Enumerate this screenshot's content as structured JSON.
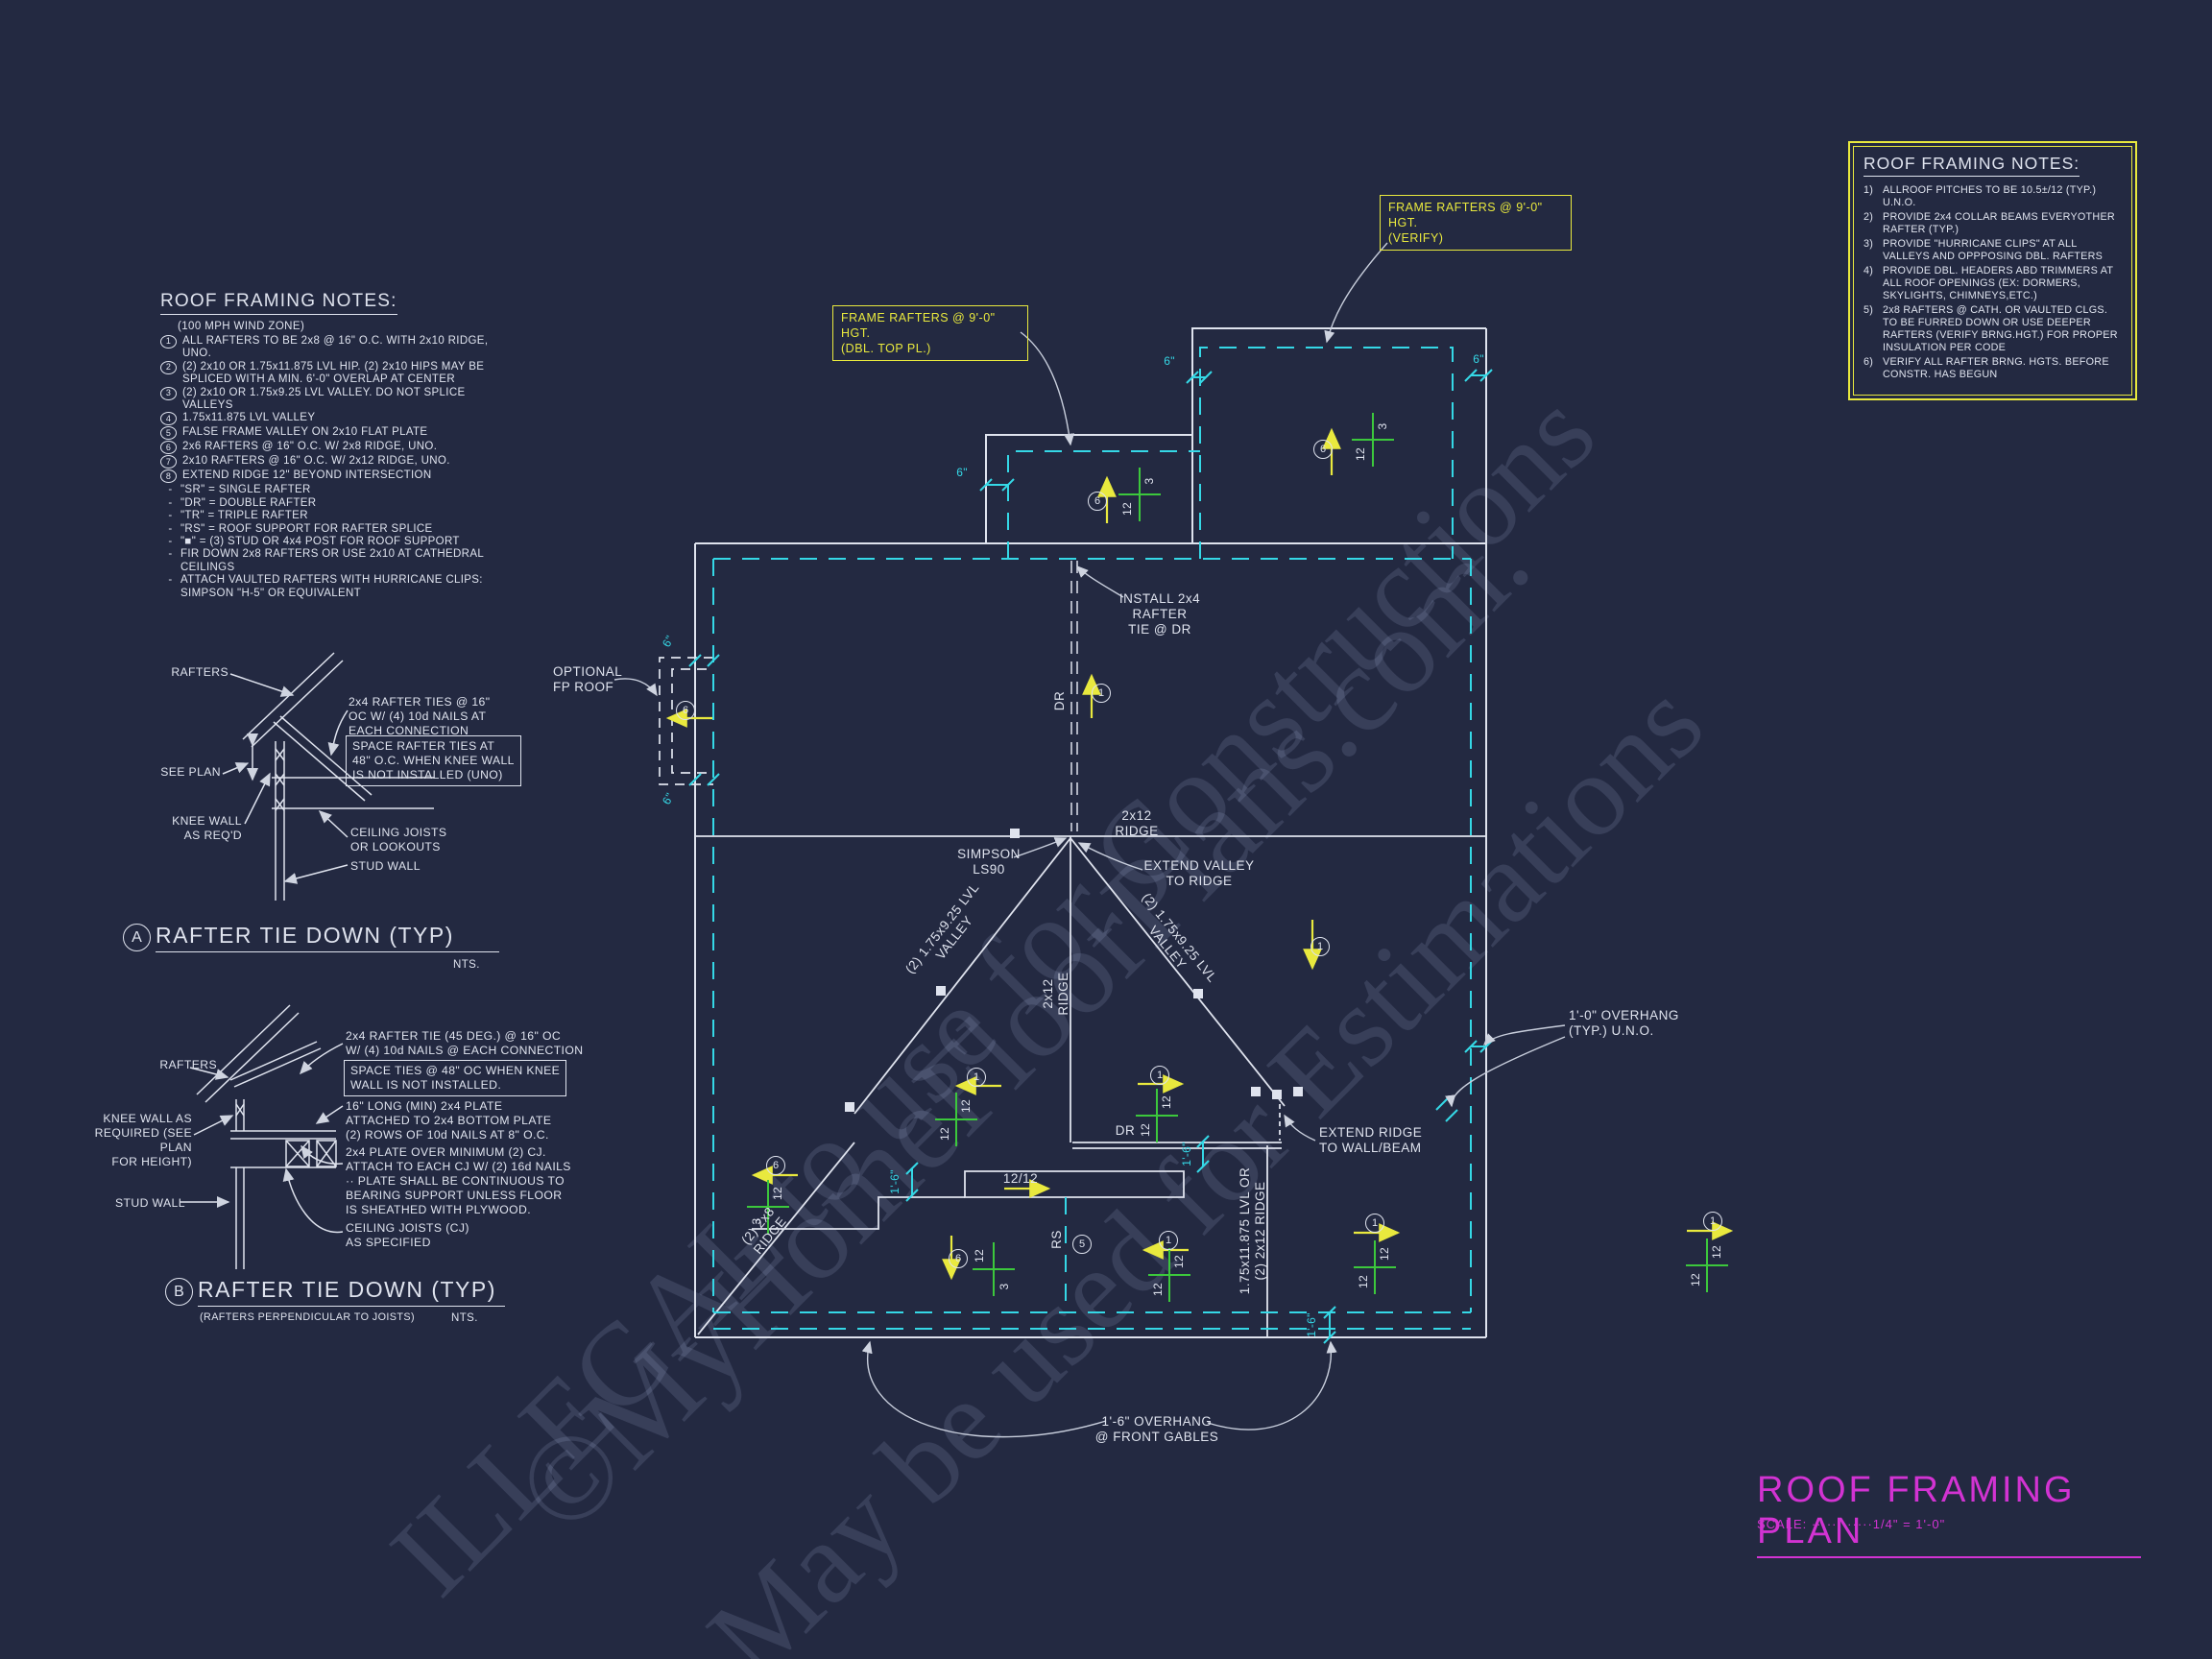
{
  "watermarks": {
    "w1": "©MyHomeFloorPlans.com.",
    "w2": "ILLEGAL to use for Constructions",
    "w3": "May be used for Estimations"
  },
  "left_notes": {
    "title": "ROOF FRAMING NOTES:",
    "subtitle": "(100 MPH WIND ZONE)",
    "numbered": [
      {
        "n": "1",
        "t": "ALL RAFTERS TO BE 2x8 @ 16\" O.C. WITH 2x10 RIDGE, UNO."
      },
      {
        "n": "2",
        "t": "(2) 2x10 OR 1.75x11.875 LVL HIP. (2) 2x10 HIPS MAY BE SPLICED WITH A MIN. 6'-0\" OVERLAP AT CENTER"
      },
      {
        "n": "3",
        "t": "(2) 2x10 OR 1.75x9.25 LVL VALLEY. DO NOT SPLICE VALLEYS"
      },
      {
        "n": "4",
        "t": "1.75x11.875 LVL VALLEY"
      },
      {
        "n": "5",
        "t": "FALSE FRAME VALLEY ON 2x10 FLAT PLATE"
      },
      {
        "n": "6",
        "t": "2x6 RAFTERS @ 16\" O.C. W/ 2x8 RIDGE, UNO."
      },
      {
        "n": "7",
        "t": "2x10 RAFTERS @ 16\" O.C. W/ 2x12 RIDGE, UNO."
      },
      {
        "n": "8",
        "t": "EXTEND RIDGE 12\" BEYOND INTERSECTION"
      }
    ],
    "dashed": [
      {
        "n": "-",
        "t": "\"SR\" = SINGLE RAFTER"
      },
      {
        "n": "-",
        "t": "\"DR\" = DOUBLE RAFTER"
      },
      {
        "n": "-",
        "t": "\"TR\" = TRIPLE RAFTER"
      },
      {
        "n": "-",
        "t": "\"RS\" = ROOF SUPPORT FOR RAFTER SPLICE"
      },
      {
        "n": "-",
        "t": "\"■\"  = (3) STUD OR 4x4 POST FOR ROOF SUPPORT"
      },
      {
        "n": "-",
        "t": "FIR DOWN 2x8 RAFTERS OR USE 2x10 AT CATHEDRAL CEILINGS"
      },
      {
        "n": "-",
        "t": "ATTACH VAULTED RAFTERS WITH HURRICANE CLIPS: SIMPSON \"H-5\" OR EQUIVALENT"
      }
    ]
  },
  "right_notes": {
    "title": "ROOF FRAMING NOTES:",
    "items": [
      {
        "n": "1)",
        "t": "ALLROOF PITCHES TO BE  10.5±/12 (TYP.) U.N.O."
      },
      {
        "n": "2)",
        "t": "PROVIDE 2x4 COLLAR BEAMS EVERYOTHER RAFTER (TYP.)"
      },
      {
        "n": "3)",
        "t": "PROVIDE \"HURRICANE CLIPS\" AT ALL VALLEYS AND OPPPOSING DBL. RAFTERS"
      },
      {
        "n": "4)",
        "t": "PROVIDE DBL. HEADERS ABD TRIMMERS AT ALL ROOF OPENINGS (EX: DORMERS, SKYLIGHTS, CHIMNEYS,ETC.)"
      },
      {
        "n": "5)",
        "t": "2x8 RAFTERS @ CATH. OR VAULTED CLGS. TO BE FURRED DOWN OR USE DEEPER RAFTERS (VERIFY BRNG.HGT.) FOR PROPER INSULATION PER CODE"
      },
      {
        "n": "6)",
        "t": "VERIFY ALL RAFTER BRNG. HGTS. BEFORE CONSTR. HAS BEGUN"
      }
    ]
  },
  "callouts": {
    "verify": {
      "l1": "FRAME RAFTERS @ 9'-0\" HGT.",
      "l2": "(VERIFY)"
    },
    "dbl": {
      "l1": "FRAME RAFTERS @ 9'-0\" HGT.",
      "l2": "(DBL. TOP PL.)"
    }
  },
  "detail_a": {
    "marker": "A",
    "nts": "NTS.",
    "title": "RAFTER TIE DOWN (TYP)",
    "rafters": "RAFTERS",
    "tie": "2x4 RAFTER TIES @ 16\"\nOC W/ (4) 10d NAILS AT\nEACH CONNECTION",
    "boxed": "SPACE RAFTER TIES AT\n48\" O.C. WHEN KNEE WALL\nIS NOT INSTALLED (UNO)",
    "see_plan": "SEE PLAN",
    "knee": "KNEE WALL\nAS REQ'D",
    "ceiling": "CEILING JOISTS\nOR LOOKOUTS",
    "stud": "STUD WALL"
  },
  "detail_b": {
    "marker": "B",
    "nts": "NTS.",
    "title": "RAFTER TIE DOWN (TYP)",
    "subtitle": "(RAFTERS PERPENDICULAR TO JOISTS)",
    "rafters": "RAFTERS",
    "tie": "2x4 RAFTER TIE (45 DEG.) @ 16\" OC\nW/ (4) 10d NAILS @ EACH CONNECTION",
    "boxed": "SPACE TIES @ 48\" OC WHEN KNEE\nWALL IS NOT INSTALLED.",
    "plate16": "16\" LONG (MIN) 2x4 PLATE\nATTACHED TO 2x4 BOTTOM PLATE\n(2) ROWS OF 10d NAILS AT 8\" O.C.",
    "plate24": "2x4 PLATE OVER MINIMUM (2) CJ.\nATTACH TO EACH CJ W/ (2) 16d NAILS\n·· PLATE SHALL BE CONTINUOUS TO\nBEARING SUPPORT UNLESS FLOOR\nIS SHEATHED WITH PLYWOOD.",
    "knee": "KNEE WALL AS\nREQUIRED (SEE PLAN\nFOR HEIGHT)",
    "stud": "STUD WALL",
    "cj": "CEILING JOISTS (CJ)\nAS SPECIFIED"
  },
  "plan": {
    "texts": {
      "install_tie": "INSTALL 2x4\nRAFTER\nTIE @ DR",
      "ridge_2x12_h": "2x12\nRIDGE",
      "ridge_2x12_v": "2x12\nRIDGE",
      "simpson": "SIMPSON\nLS90",
      "extend_valley": "EXTEND VALLEY\nTO RIDGE",
      "valley_left": "(2) 1.75x9.25 LVL\nVALLEY",
      "valley_right": "(2) 1.75x9.25 LVL\nVALLEY",
      "dr_bar": "DR",
      "dr_vert": "DR",
      "rs": "RS",
      "ridge_2x8": "(2) 2x8\nRIDGE",
      "ridge_lvl": "1.75x11.875 LVL OR\n(2) 2x12 RIDGE",
      "slope_12_12": "12/12",
      "extend_ridge": "EXTEND RIDGE\nTO WALL/BEAM",
      "overhang_1_0": "1'-0\" OVERHANG\n(TYP.) U.N.O.",
      "overhang_1_6": "1'-6\" OVERHANG\n@ FRONT GABLES",
      "optional_fp": "OPTIONAL\nFP ROOF",
      "dim_6": "6\"",
      "dim_1_6": "1'-6\""
    },
    "slope": {
      "twelve": "12",
      "three": "3"
    },
    "markers": {
      "one": "1",
      "five": "5",
      "six": "6"
    }
  },
  "title_block": {
    "title": "ROOF FRAMING PLAN",
    "scale": "SCALE: ············1/4\" = 1'-0\""
  }
}
